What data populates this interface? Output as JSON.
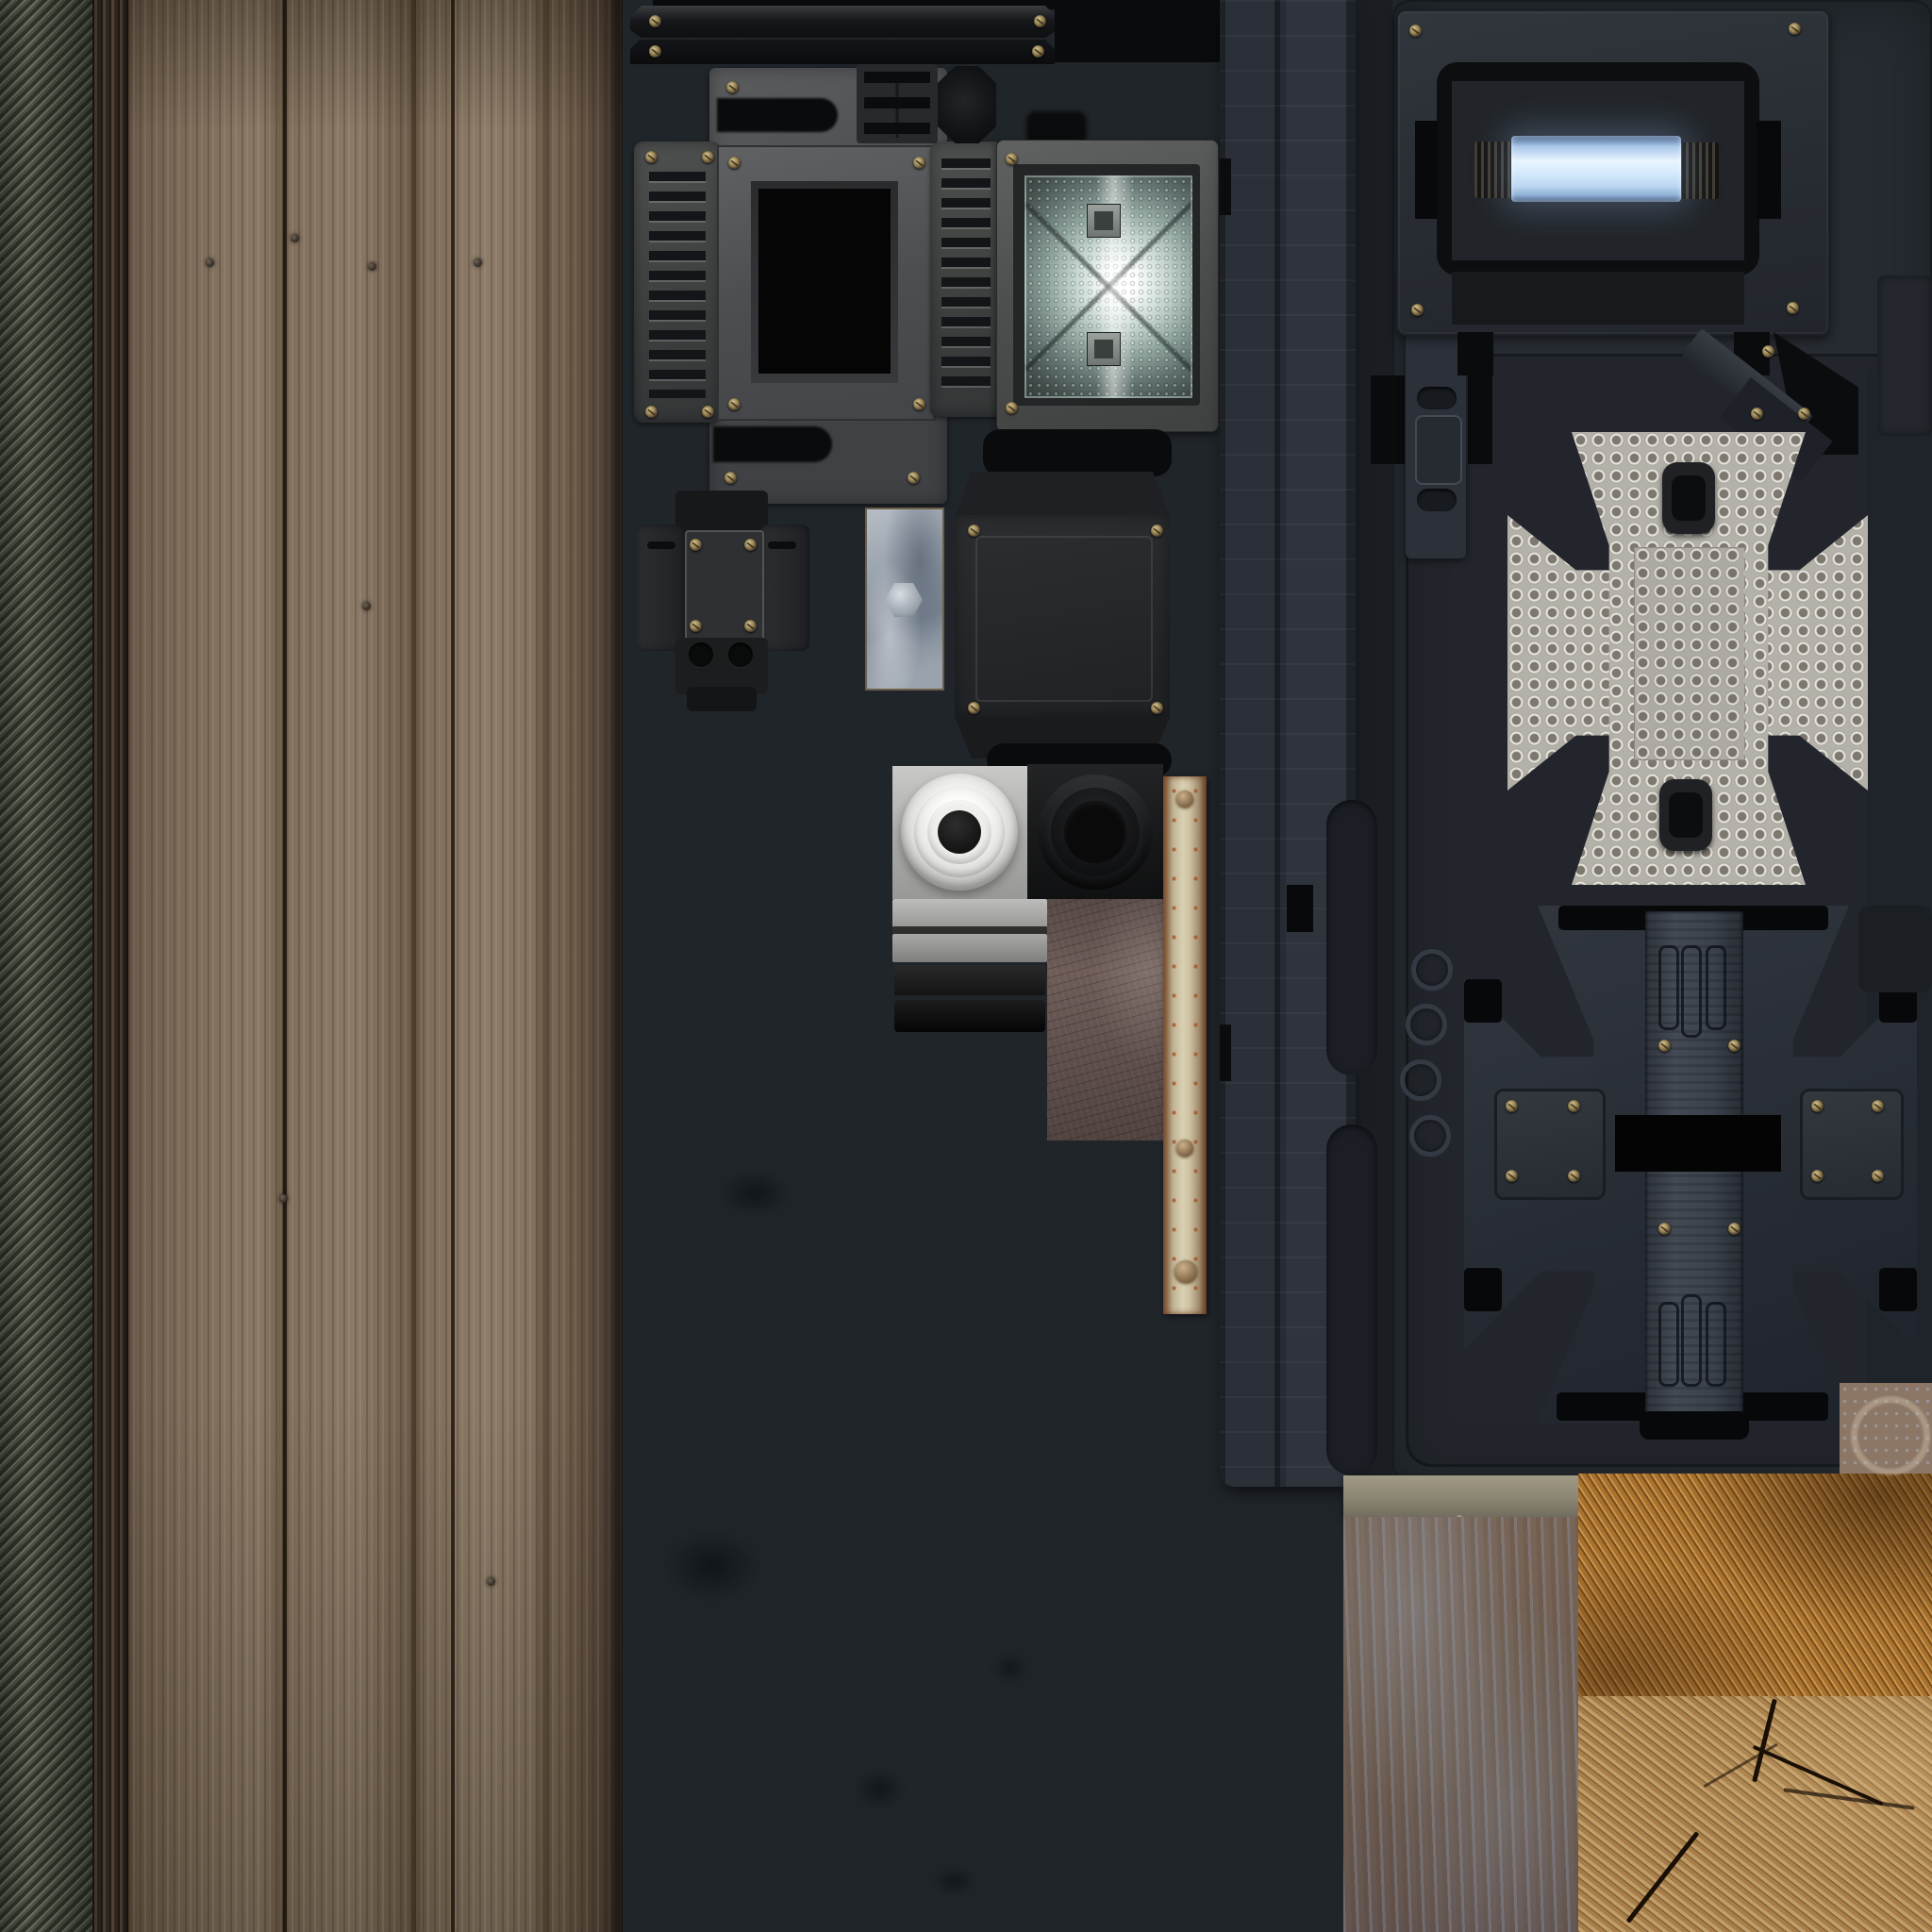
{
  "atlas": {
    "kind": "game-texture-atlas",
    "description": "2048x2048 texture atlas sheet for a sci-fi/industrial prop: wood plank strips, ribbed metal, lamp housings, vents, knobs, cross-shaped padded plates and weathered wood blocks laid out on a dark charcoal background",
    "background_color": "#20252a",
    "visible_text": ""
  },
  "palette": {
    "background_left": "#20252a",
    "background_right_panel": "#262b31",
    "ribbed_metal_green": "#4c5244",
    "wood_plank_brown": "#84715e",
    "metal_gray": "#55575a",
    "vent_slot_dark": "#141518",
    "floodlight_glow": "#ffffff",
    "floodlight_reflector": "#c3d3cd",
    "lamp_tube_blue": "#d5eafc",
    "lamp_tube_edge_blue": "#49648e",
    "dimpled_plate_gray": "#b4b1a9",
    "dark_cross_gray": "#2c313a",
    "white_knob": "#efeeeb",
    "black_knob": "#0a0a0b",
    "leather_brown": "#6e5c58",
    "batten_tan": "#d9d0b2",
    "rust_orange": "#b0532a",
    "rust_panel_brown": "#6b594c",
    "rust_panel_blue_scrape": "#8b98ad",
    "sawn_wood_orange": "#a8742f",
    "end_grain_tan": "#b08a55",
    "crack_dark": "#1a0f05",
    "screw_brass": "#a08a58"
  },
  "regions": [
    {
      "id": "ribbed-strip",
      "label": "diagonal ribbed metal strip",
      "colors": [
        "#6a7160",
        "#4c5244",
        "#30352a"
      ]
    },
    {
      "id": "wood-planks",
      "label": "weathered vertical wood planks with nails",
      "colors": [
        "#8a7966",
        "#6b5947",
        "#3f332a"
      ]
    },
    {
      "id": "top-rail-bars",
      "label": "dark metal rail bars with corner screws",
      "colors": [
        "#17181b",
        "#0b0c0e"
      ]
    },
    {
      "id": "handle-plate",
      "label": "gray plate with recessed handle slots",
      "colors": [
        "#5a5c5e",
        "#0a0b0c"
      ]
    },
    {
      "id": "vent-panels",
      "label": "slotted vent panels",
      "colors": [
        "#46484a",
        "#141518"
      ]
    },
    {
      "id": "screen-frame",
      "label": "frame with black screen opening",
      "colors": [
        "#515456",
        "#050505"
      ]
    },
    {
      "id": "floodlight",
      "label": "floodlight housing with bright reflector and two lamp holders",
      "colors": [
        "#565857",
        "#ffffff",
        "#90a49e"
      ]
    },
    {
      "id": "ribbed-connector",
      "label": "small ribbed connector block",
      "colors": [
        "#27292c"
      ]
    },
    {
      "id": "octagon-cap",
      "label": "octagonal end cap",
      "colors": [
        "#121315"
      ]
    },
    {
      "id": "mounting-bracket",
      "label": "cross-shaped mounting bracket with two holes",
      "colors": [
        "#26282b"
      ]
    },
    {
      "id": "galvanized-plate",
      "label": "galvanized plate with hex bolt",
      "colors": [
        "#97a1ac",
        "#6b5f49"
      ]
    },
    {
      "id": "flanged-box",
      "label": "flanged junction box with rounded black bars",
      "colors": [
        "#2c2e31",
        "#0a0b0c"
      ]
    },
    {
      "id": "white-ring-knob",
      "label": "white concentric-ring knob tile",
      "colors": [
        "#efeeeb",
        "#141414"
      ]
    },
    {
      "id": "black-ring-knob",
      "label": "black concentric-ring knob tile",
      "colors": [
        "#1a1b1c",
        "#0a0a0b"
      ]
    },
    {
      "id": "step-trims",
      "label": "stacked gray and black trim bars",
      "colors": [
        "#bdbdbb",
        "#141414"
      ]
    },
    {
      "id": "leather-panel",
      "label": "scratched leather/painted wood rectangle",
      "colors": [
        "#6e5c58"
      ]
    },
    {
      "id": "wood-batten",
      "label": "rusty tan wooden batten with rivets",
      "colors": [
        "#d9d0b2",
        "#b0532a",
        "#8a6f4f"
      ]
    },
    {
      "id": "rail-column",
      "label": "tall vertical rail column with grooves and notches",
      "colors": [
        "#2b3038",
        "#1b1f25"
      ]
    },
    {
      "id": "slotted-rail",
      "label": "short slotted rail piece",
      "colors": [
        "#2b3039",
        "#171a1f"
      ]
    },
    {
      "id": "embossed-rings",
      "label": "four embossed ring outlines",
      "colors": [
        "#343a43"
      ]
    },
    {
      "id": "glow-lamp-panel",
      "label": "panel with glowing blue light tube and corner screws",
      "colors": [
        "#2b2f35",
        "#e9f5ff",
        "#49648e"
      ]
    },
    {
      "id": "corner-wedge",
      "label": "angled corner bracket with screws",
      "colors": [
        "#383d45",
        "#0b0c0e"
      ]
    },
    {
      "id": "dimpled-cross",
      "label": "light gray dimpled maltese-cross plate with two dark pads",
      "colors": [
        "#b4b1a9",
        "#202124"
      ]
    },
    {
      "id": "dark-cross",
      "label": "dark maltese-cross back plate with screw plates and stitched band",
      "colors": [
        "#2c313a",
        "#040404"
      ]
    },
    {
      "id": "stain-ring-tile",
      "label": "small tile with circular stain ring",
      "colors": [
        "#8c7767"
      ]
    },
    {
      "id": "rust-panel",
      "label": "painted rust panel with concrete lip and blue-gray scrapes",
      "colors": [
        "#6b594c",
        "#8b98ad",
        "#8a8472"
      ]
    },
    {
      "id": "sawn-wood",
      "label": "rough sawn orange wood block",
      "colors": [
        "#a8742f"
      ]
    },
    {
      "id": "end-grain-wood",
      "label": "cracked end-grain wood block",
      "colors": [
        "#b08a55",
        "#1a0f05"
      ]
    }
  ]
}
